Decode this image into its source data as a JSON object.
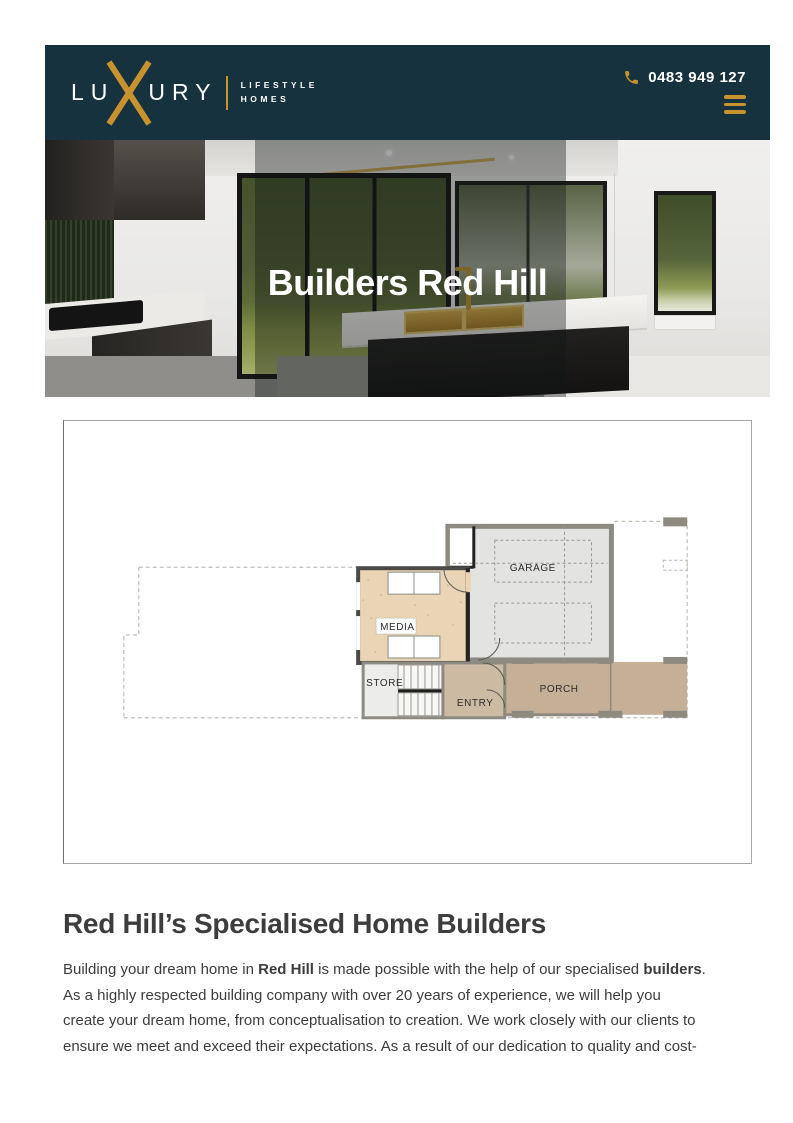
{
  "header": {
    "colors": {
      "background": "#16323E",
      "gold": "#C8922F"
    },
    "logo": {
      "word_start": "LU",
      "word_end": "URY",
      "tagline_top": "LIFESTYLE",
      "tagline_bottom": "HOMES"
    },
    "phone_number": "0483 949 127"
  },
  "hero": {
    "title": "Builders Red Hill"
  },
  "floorplan": {
    "rooms": {
      "garage": "GARAGE",
      "media": "MEDIA",
      "store": "STORE",
      "entry": "ENTRY",
      "porch": "PORCH"
    }
  },
  "content": {
    "heading": "Red Hill’s Specialised Home Builders",
    "paragraph_lines": [
      [
        {
          "t": "Building your dream home in ",
          "b": false
        },
        {
          "t": "Red Hill",
          "b": true
        },
        {
          "t": " is made possible with the help of our specialised ",
          "b": false
        },
        {
          "t": "builders",
          "b": true
        },
        {
          "t": ".",
          "b": false
        }
      ],
      [
        {
          "t": "As a highly respected building company with over 20 years of experience, we will help you",
          "b": false
        }
      ],
      [
        {
          "t": "create your dream home, from conceptualisation to creation. We work closely with our clients to",
          "b": false
        }
      ],
      [
        {
          "t": "ensure we meet and exceed their expectations. As a result of our dedication to quality and cost-",
          "b": false
        }
      ]
    ]
  }
}
